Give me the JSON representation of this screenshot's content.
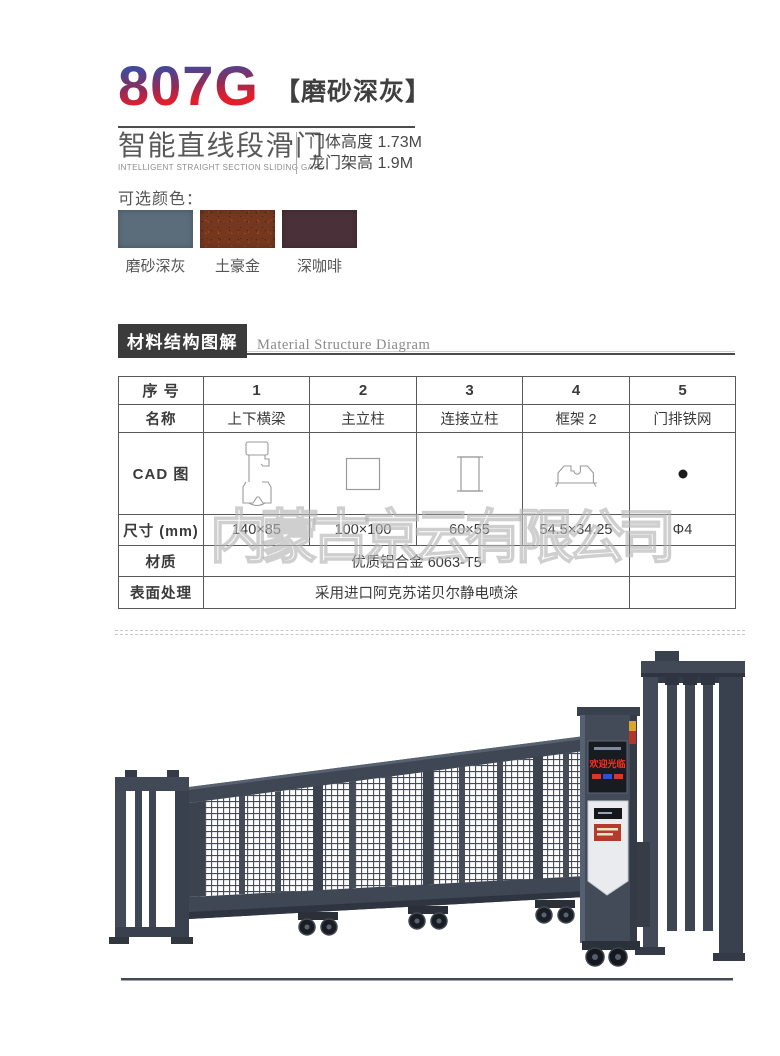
{
  "header": {
    "model": "807G",
    "variant": "【磨砂深灰】",
    "product_cn": "智能直线段滑门",
    "product_en": "INTELLIGENT STRAIGHT SECTION SLIDING GATE",
    "specs": [
      "门体高度 1.73M",
      "龙门架高 1.9M"
    ]
  },
  "colors": {
    "label": "可选颜色：",
    "options": [
      {
        "name": "磨砂深灰",
        "hex": "#5b6d7b"
      },
      {
        "name": "土豪金",
        "hex": "#75381f"
      },
      {
        "name": "深咖啡",
        "hex": "#4a3038"
      }
    ]
  },
  "section": {
    "title_cn": "材料结构图解",
    "title_en": "Material Structure Diagram"
  },
  "table": {
    "row_headers": [
      "序 号",
      "名称",
      "CAD 图",
      "尺寸 (mm)",
      "材质",
      "表面处理"
    ],
    "columns": [
      "1",
      "2",
      "3",
      "4",
      "5"
    ],
    "names": [
      "上下横梁",
      "主立柱",
      "连接立柱",
      "框架 2",
      "门排铁网"
    ],
    "sizes": [
      "140×85",
      "100×100",
      "60×55",
      "54.5×34.25",
      "Φ4"
    ],
    "material": "优质铝合金 6063-T5",
    "surface": "采用进口阿克苏诺贝尔静电喷涂"
  },
  "watermark": "内蒙古京云有限公司",
  "illustration": {
    "led_text": "欢迎光临"
  }
}
